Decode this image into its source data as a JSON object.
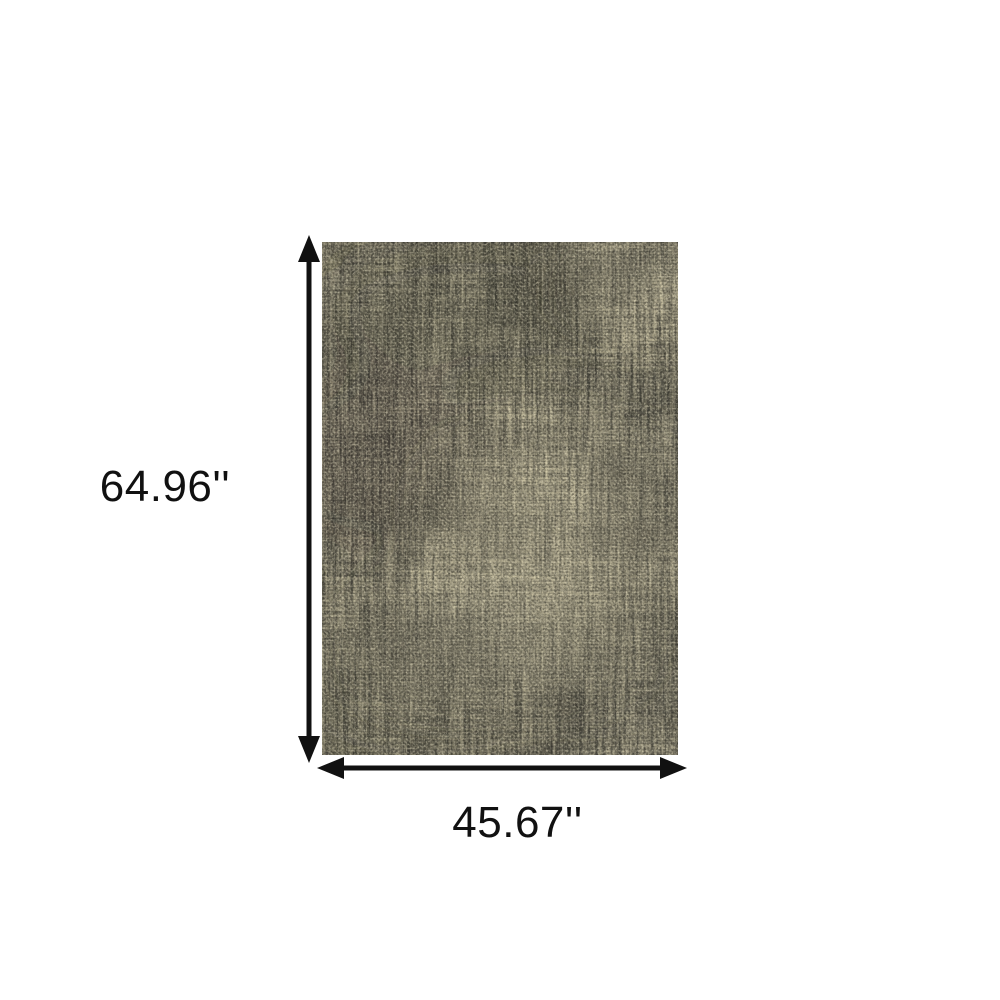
{
  "background_color": "#ffffff",
  "rug": {
    "description": "distressed-abstract-area-rug",
    "colors": {
      "base": "#7e7967",
      "dark_charcoal": "#3e3d35",
      "deep_shadow": "#34332c",
      "mid_gray": "#6a675a",
      "beige": "#d3caa8",
      "ivory_highlight": "#e7e0c3"
    }
  },
  "dimensions": {
    "height_label": "64.96''",
    "width_label": "45.67''"
  },
  "annotation": {
    "arrow_color": "#111111"
  }
}
